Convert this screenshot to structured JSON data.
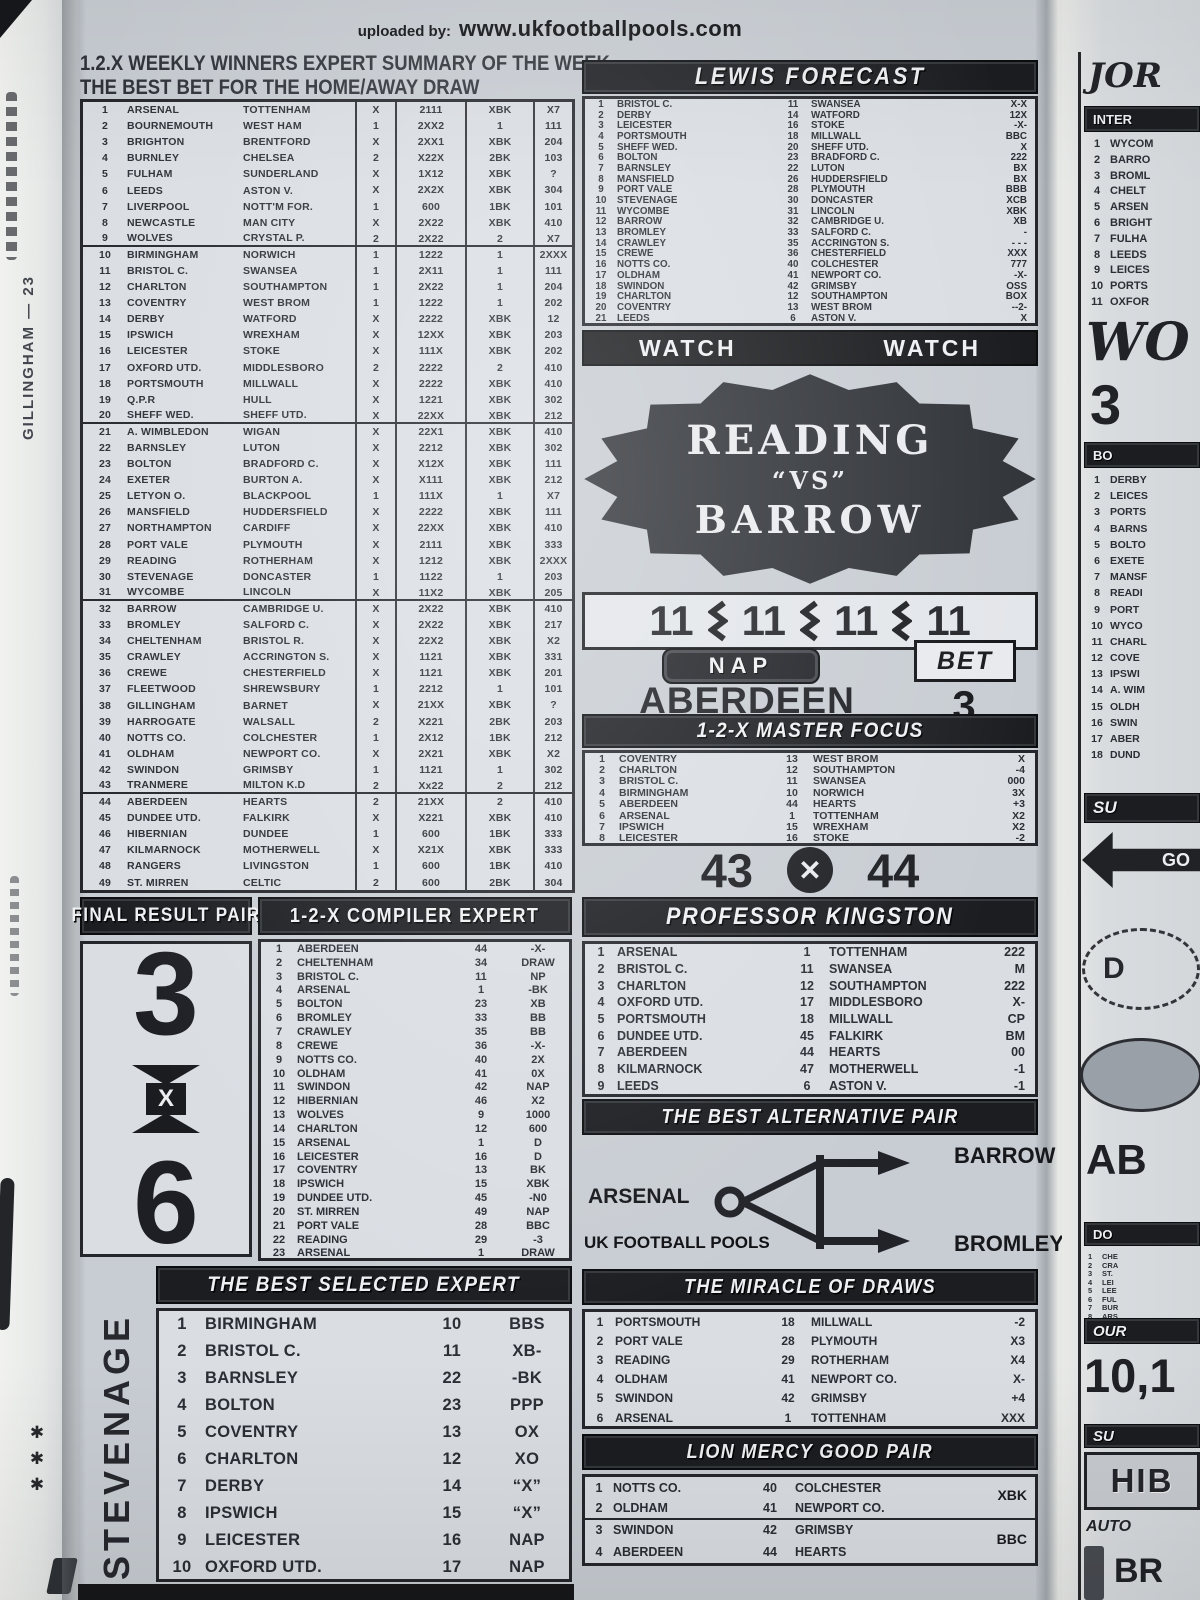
{
  "credit": {
    "prefix": "uploaded by:",
    "site": "www.ukfootballpools.com"
  },
  "left_strip": {
    "vertical_text": "GILLINGHAM — 23",
    "marks": "✱ ✱ ✱"
  },
  "weekly_summary": {
    "title_line1": "1.2.X WEEKLY WINNERS EXPERT SUMMARY OF THE WEEK",
    "title_line2": "THE BEST BET FOR THE HOME/AWAY DRAW",
    "rows": [
      [
        1,
        "ARSENAL",
        "TOTTENHAM",
        "X",
        "2111",
        "XBK",
        "X7"
      ],
      [
        2,
        "BOURNEMOUTH",
        "WEST HAM",
        "1",
        "2XX2",
        "1",
        "111"
      ],
      [
        3,
        "BRIGHTON",
        "BRENTFORD",
        "X",
        "2XX1",
        "XBK",
        "204"
      ],
      [
        4,
        "BURNLEY",
        "CHELSEA",
        "2",
        "X22X",
        "2BK",
        "103"
      ],
      [
        5,
        "FULHAM",
        "SUNDERLAND",
        "X",
        "1X12",
        "XBK",
        "?"
      ],
      [
        6,
        "LEEDS",
        "ASTON V.",
        "X",
        "2X2X",
        "XBK",
        "304"
      ],
      [
        7,
        "LIVERPOOL",
        "NOTT'M FOR.",
        "1",
        "600",
        "1BK",
        "101"
      ],
      [
        8,
        "NEWCASTLE",
        "MAN CITY",
        "X",
        "2X22",
        "XBK",
        "410"
      ],
      [
        9,
        "WOLVES",
        "CRYSTAL P.",
        "2",
        "2X22",
        "2",
        "X7"
      ],
      [
        10,
        "BIRMINGHAM",
        "NORWICH",
        "1",
        "1222",
        "1",
        "2XXX"
      ],
      [
        11,
        "BRISTOL C.",
        "SWANSEA",
        "1",
        "2X11",
        "1",
        "111"
      ],
      [
        12,
        "CHARLTON",
        "SOUTHAMPTON",
        "1",
        "2X22",
        "1",
        "204"
      ],
      [
        13,
        "COVENTRY",
        "WEST BROM",
        "1",
        "1222",
        "1",
        "202"
      ],
      [
        14,
        "DERBY",
        "WATFORD",
        "X",
        "2222",
        "XBK",
        "12"
      ],
      [
        15,
        "IPSWICH",
        "WREXHAM",
        "X",
        "12XX",
        "XBK",
        "203"
      ],
      [
        16,
        "LEICESTER",
        "STOKE",
        "X",
        "111X",
        "XBK",
        "202"
      ],
      [
        17,
        "OXFORD UTD.",
        "MIDDLESBORO",
        "2",
        "2222",
        "2",
        "410"
      ],
      [
        18,
        "PORTSMOUTH",
        "MILLWALL",
        "X",
        "2222",
        "XBK",
        "410"
      ],
      [
        19,
        "Q.P.R",
        "HULL",
        "X",
        "1221",
        "XBK",
        "302"
      ],
      [
        20,
        "SHEFF WED.",
        "SHEFF UTD.",
        "X",
        "22XX",
        "XBK",
        "212"
      ],
      [
        21,
        "A. WIMBLEDON",
        "WIGAN",
        "X",
        "22X1",
        "XBK",
        "410"
      ],
      [
        22,
        "BARNSLEY",
        "LUTON",
        "X",
        "2212",
        "XBK",
        "302"
      ],
      [
        23,
        "BOLTON",
        "BRADFORD C.",
        "X",
        "X12X",
        "XBK",
        "111"
      ],
      [
        24,
        "EXETER",
        "BURTON A.",
        "X",
        "X111",
        "XBK",
        "212"
      ],
      [
        25,
        "LETYON O.",
        "BLACKPOOL",
        "1",
        "111X",
        "1",
        "X7"
      ],
      [
        26,
        "MANSFIELD",
        "HUDDERSFIELD",
        "X",
        "2222",
        "XBK",
        "111"
      ],
      [
        27,
        "NORTHAMPTON",
        "CARDIFF",
        "X",
        "22XX",
        "XBK",
        "410"
      ],
      [
        28,
        "PORT VALE",
        "PLYMOUTH",
        "X",
        "2111",
        "XBK",
        "333"
      ],
      [
        29,
        "READING",
        "ROTHERHAM",
        "X",
        "1212",
        "XBK",
        "2XXX"
      ],
      [
        30,
        "STEVENAGE",
        "DONCASTER",
        "1",
        "1122",
        "1",
        "203"
      ],
      [
        31,
        "WYCOMBE",
        "LINCOLN",
        "X",
        "11X2",
        "XBK",
        "205"
      ],
      [
        32,
        "BARROW",
        "CAMBRIDGE U.",
        "X",
        "2X22",
        "XBK",
        "410"
      ],
      [
        33,
        "BROMLEY",
        "SALFORD C.",
        "X",
        "2X22",
        "XBK",
        "217"
      ],
      [
        34,
        "CHELTENHAM",
        "BRISTOL R.",
        "X",
        "22X2",
        "XBK",
        "X2"
      ],
      [
        35,
        "CRAWLEY",
        "ACCRINGTON S.",
        "X",
        "1121",
        "XBK",
        "331"
      ],
      [
        36,
        "CREWE",
        "CHESTERFIELD",
        "X",
        "1121",
        "XBK",
        "201"
      ],
      [
        37,
        "FLEETWOOD",
        "SHREWSBURY",
        "1",
        "2212",
        "1",
        "101"
      ],
      [
        38,
        "GILLINGHAM",
        "BARNET",
        "X",
        "21XX",
        "XBK",
        "?"
      ],
      [
        39,
        "HARROGATE",
        "WALSALL",
        "2",
        "X221",
        "2BK",
        "203"
      ],
      [
        40,
        "NOTTS CO.",
        "COLCHESTER",
        "1",
        "2X12",
        "1BK",
        "212"
      ],
      [
        41,
        "OLDHAM",
        "NEWPORT CO.",
        "X",
        "2X21",
        "XBK",
        "X2"
      ],
      [
        42,
        "SWINDON",
        "GRIMSBY",
        "1",
        "1121",
        "1",
        "302"
      ],
      [
        43,
        "TRANMERE",
        "MILTON K.D",
        "2",
        "Xx22",
        "2",
        "212"
      ],
      [
        44,
        "ABERDEEN",
        "HEARTS",
        "2",
        "21XX",
        "2",
        "410"
      ],
      [
        45,
        "DUNDEE UTD.",
        "FALKIRK",
        "X",
        "X221",
        "XBK",
        "410"
      ],
      [
        46,
        "HIBERNIAN",
        "DUNDEE",
        "1",
        "600",
        "1BK",
        "333"
      ],
      [
        47,
        "KILMARNOCK",
        "MOTHERWELL",
        "X",
        "X21X",
        "XBK",
        "333"
      ],
      [
        48,
        "RANGERS",
        "LIVINGSTON",
        "1",
        "600",
        "1BK",
        "410"
      ],
      [
        49,
        "ST. MIRREN",
        "CELTIC",
        "2",
        "600",
        "2BK",
        "304"
      ]
    ]
  },
  "lewis_forecast": {
    "title": "LEWIS FORECAST",
    "rows": [
      [
        1,
        "BRISTOL C.",
        11,
        "SWANSEA",
        "X-X"
      ],
      [
        2,
        "DERBY",
        14,
        "WATFORD",
        "12X"
      ],
      [
        3,
        "LEICESTER",
        16,
        "STOKE",
        "-X-"
      ],
      [
        4,
        "PORTSMOUTH",
        18,
        "MILLWALL",
        "BBC"
      ],
      [
        5,
        "SHEFF WED.",
        20,
        "SHEFF UTD.",
        "X"
      ],
      [
        6,
        "BOLTON",
        23,
        "BRADFORD C.",
        "222"
      ],
      [
        7,
        "BARNSLEY",
        22,
        "LUTON",
        "BX"
      ],
      [
        8,
        "MANSFIELD",
        26,
        "HUDDERSFIELD",
        "BX"
      ],
      [
        9,
        "PORT VALE",
        28,
        "PLYMOUTH",
        "BBB"
      ],
      [
        10,
        "STEVENAGE",
        30,
        "DONCASTER",
        "XCB"
      ],
      [
        11,
        "WYCOMBE",
        31,
        "LINCOLN",
        "XBK"
      ],
      [
        12,
        "BARROW",
        32,
        "CAMBRIDGE U.",
        "XB"
      ],
      [
        13,
        "BROMLEY",
        33,
        "SALFORD C.",
        "-"
      ],
      [
        14,
        "CRAWLEY",
        35,
        "ACCRINGTON S.",
        "- - -"
      ],
      [
        15,
        "CREWE",
        36,
        "CHESTERFIELD",
        "XXX"
      ],
      [
        16,
        "NOTTS CO.",
        40,
        "COLCHESTER",
        "777"
      ],
      [
        17,
        "OLDHAM",
        41,
        "NEWPORT CO.",
        "-X-"
      ],
      [
        18,
        "SWINDON",
        42,
        "GRIMSBY",
        "OSS"
      ],
      [
        19,
        "CHARLTON",
        12,
        "SOUTHAMPTON",
        "BOX"
      ],
      [
        20,
        "COVENTRY",
        13,
        "WEST BROM",
        "--2-"
      ],
      [
        21,
        "LEEDS",
        6,
        "ASTON V.",
        "X"
      ]
    ]
  },
  "watch": {
    "left": "WATCH",
    "right": "WATCH"
  },
  "seal": {
    "line1": "READING",
    "line2": "“VS”",
    "line3": "BARROW"
  },
  "quad11": {
    "v0": "11",
    "v1": "11",
    "v2": "11",
    "v3": "11"
  },
  "nap": {
    "label": "NAP",
    "team": "ABERDEEN",
    "bet_label": "BET",
    "bet_value": "3"
  },
  "master_focus": {
    "title": "1-2-X MASTER FOCUS",
    "rows": [
      [
        1,
        "COVENTRY",
        13,
        "WEST BROM",
        "X"
      ],
      [
        2,
        "CHARLTON",
        12,
        "SOUTHAMPTON",
        "-4"
      ],
      [
        3,
        "BRISTOL C.",
        11,
        "SWANSEA",
        "000"
      ],
      [
        4,
        "BIRMINGHAM",
        10,
        "NORWICH",
        "3X"
      ],
      [
        5,
        "ABERDEEN",
        44,
        "HEARTS",
        "+3"
      ],
      [
        6,
        "ARSENAL",
        1,
        "TOTTENHAM",
        "X2"
      ],
      [
        7,
        "IPSWICH",
        15,
        "WREXHAM",
        "X2"
      ],
      [
        8,
        "LEICESTER",
        16,
        "STOKE",
        "-2"
      ]
    ]
  },
  "pair_43_44": {
    "left": "43",
    "x": "✕",
    "right": "44"
  },
  "final_result_pair": {
    "title": "FINAL RESULT PAIR",
    "top": "3",
    "x": "X",
    "bottom": "6"
  },
  "compiler_expert": {
    "title": "1-2-X COMPILER EXPERT",
    "rows": [
      [
        1,
        "ABERDEEN",
        44,
        "-X-"
      ],
      [
        2,
        "CHELTENHAM",
        34,
        "DRAW"
      ],
      [
        3,
        "BRISTOL C.",
        11,
        "NP"
      ],
      [
        4,
        "ARSENAL",
        1,
        "-BK"
      ],
      [
        5,
        "BOLTON",
        23,
        "XB"
      ],
      [
        6,
        "BROMLEY",
        33,
        "BB"
      ],
      [
        7,
        "CRAWLEY",
        35,
        "BB"
      ],
      [
        8,
        "CREWE",
        36,
        "-X-"
      ],
      [
        9,
        "NOTTS CO.",
        40,
        "2X"
      ],
      [
        10,
        "OLDHAM",
        41,
        "0X"
      ],
      [
        11,
        "SWINDON",
        42,
        "NAP"
      ],
      [
        12,
        "HIBERNIAN",
        46,
        "X2"
      ],
      [
        13,
        "WOLVES",
        9,
        "1000"
      ],
      [
        14,
        "CHARLTON",
        12,
        "600"
      ],
      [
        15,
        "ARSENAL",
        1,
        "D"
      ],
      [
        16,
        "LEICESTER",
        16,
        "D"
      ],
      [
        17,
        "COVENTRY",
        13,
        "BK"
      ],
      [
        18,
        "IPSWICH",
        15,
        "XBK"
      ],
      [
        19,
        "DUNDEE UTD.",
        45,
        "-N0"
      ],
      [
        20,
        "ST. MIRREN",
        49,
        "NAP"
      ],
      [
        21,
        "PORT VALE",
        28,
        "BBC"
      ],
      [
        22,
        "READING",
        29,
        "-3"
      ],
      [
        23,
        "ARSENAL",
        1,
        "DRAW"
      ]
    ]
  },
  "professor_kingston": {
    "title": "PROFESSOR KINGSTON",
    "rows": [
      [
        1,
        "ARSENAL",
        1,
        "TOTTENHAM",
        "222"
      ],
      [
        2,
        "BRISTOL C.",
        11,
        "SWANSEA",
        "M"
      ],
      [
        3,
        "CHARLTON",
        12,
        "SOUTHAMPTON",
        "222"
      ],
      [
        4,
        "OXFORD UTD.",
        17,
        "MIDDLESBORO",
        "X-"
      ],
      [
        5,
        "PORTSMOUTH",
        18,
        "MILLWALL",
        "CP"
      ],
      [
        6,
        "DUNDEE UTD.",
        45,
        "FALKIRK",
        "BM"
      ],
      [
        7,
        "ABERDEEN",
        44,
        "HEARTS",
        "00"
      ],
      [
        8,
        "KILMARNOCK",
        47,
        "MOTHERWELL",
        "-1"
      ],
      [
        9,
        "LEEDS",
        6,
        "ASTON V.",
        "-1"
      ]
    ]
  },
  "alternative_pair": {
    "title": "THE BEST ALTERNATIVE PAIR",
    "left_team": "ARSENAL",
    "top_team": "BARROW",
    "bottom_team": "BROMLEY",
    "watermark": "UK FOOTBALL POOLS"
  },
  "best_selected": {
    "title": "THE BEST SELECTED EXPERT",
    "side_label": "STEVENAGE",
    "rows": [
      [
        1,
        "BIRMINGHAM",
        10,
        "BBS"
      ],
      [
        2,
        "BRISTOL C.",
        11,
        "XB-"
      ],
      [
        3,
        "BARNSLEY",
        22,
        "-BK"
      ],
      [
        4,
        "BOLTON",
        23,
        "PPP"
      ],
      [
        5,
        "COVENTRY",
        13,
        "OX"
      ],
      [
        6,
        "CHARLTON",
        12,
        "XO"
      ],
      [
        7,
        "DERBY",
        14,
        "“X”"
      ],
      [
        8,
        "IPSWICH",
        15,
        "“X”"
      ],
      [
        9,
        "LEICESTER",
        16,
        "NAP"
      ],
      [
        10,
        "OXFORD UTD.",
        17,
        "NAP"
      ]
    ]
  },
  "miracle_draws": {
    "title": "THE MIRACLE OF DRAWS",
    "rows": [
      [
        1,
        "PORTSMOUTH",
        18,
        "MILLWALL",
        "-2"
      ],
      [
        2,
        "PORT VALE",
        28,
        "PLYMOUTH",
        "X3"
      ],
      [
        3,
        "READING",
        29,
        "ROTHERHAM",
        "X4"
      ],
      [
        4,
        "OLDHAM",
        41,
        "NEWPORT CO.",
        "X-"
      ],
      [
        5,
        "SWINDON",
        42,
        "GRIMSBY",
        "+4"
      ],
      [
        6,
        "ARSENAL",
        1,
        "TOTTENHAM",
        "XXX"
      ]
    ]
  },
  "lion_mercy": {
    "title": "LION MERCY GOOD PAIR",
    "rows": [
      [
        1,
        "NOTTS CO.",
        40,
        "COLCHESTER"
      ],
      [
        2,
        "OLDHAM",
        41,
        "NEWPORT CO."
      ],
      [
        3,
        "SWINDON",
        42,
        "GRIMSBY"
      ],
      [
        4,
        "ABERDEEN",
        44,
        "HEARTS"
      ]
    ],
    "pair_codes": [
      "XBK",
      "BBC"
    ]
  },
  "right_strip": {
    "top_title": "JOR",
    "band1": "INTER",
    "list1": [
      [
        1,
        "WYCOM"
      ],
      [
        2,
        "BARRO"
      ],
      [
        3,
        "BROML"
      ],
      [
        4,
        "CHELT"
      ],
      [
        5,
        "ARSEN"
      ],
      [
        6,
        "BRIGHT"
      ],
      [
        7,
        "FULHA"
      ],
      [
        8,
        "LEEDS"
      ],
      [
        9,
        "LEICES"
      ],
      [
        10,
        "PORTS"
      ],
      [
        11,
        "OXFOR"
      ]
    ],
    "big_word": "WO",
    "big_number": "3",
    "band2": "BO",
    "list2": [
      [
        1,
        "DERBY"
      ],
      [
        2,
        "LEICES"
      ],
      [
        3,
        "PORTS"
      ],
      [
        4,
        "BARNS"
      ],
      [
        5,
        "BOLTO"
      ],
      [
        6,
        "EXETE"
      ],
      [
        7,
        "MANSF"
      ],
      [
        8,
        "READI"
      ],
      [
        9,
        "PORT"
      ],
      [
        10,
        "WYCO"
      ],
      [
        11,
        "CHARL"
      ],
      [
        12,
        "COVE"
      ],
      [
        13,
        "IPSWI"
      ],
      [
        14,
        "A. WIM"
      ],
      [
        15,
        "OLDH"
      ],
      [
        16,
        "SWIN"
      ],
      [
        17,
        "ABER"
      ],
      [
        18,
        "DUND"
      ]
    ],
    "band3": "SU",
    "arrow_label": "GO",
    "oval_label": "D",
    "big_text2": "AB",
    "band4": "DO",
    "tiny_list": [
      [
        1,
        "CHE"
      ],
      [
        2,
        "CRA"
      ],
      [
        3,
        "ST."
      ],
      [
        4,
        "LEI"
      ],
      [
        5,
        "LEE"
      ],
      [
        6,
        "FUL"
      ],
      [
        7,
        "BUR"
      ],
      [
        8,
        "ARS"
      ]
    ],
    "band5": "OUR",
    "big_number2": "10,1",
    "band6": "SU",
    "box_text": "HIB",
    "italic_text": "AUTO",
    "bottom_text": "BR"
  }
}
